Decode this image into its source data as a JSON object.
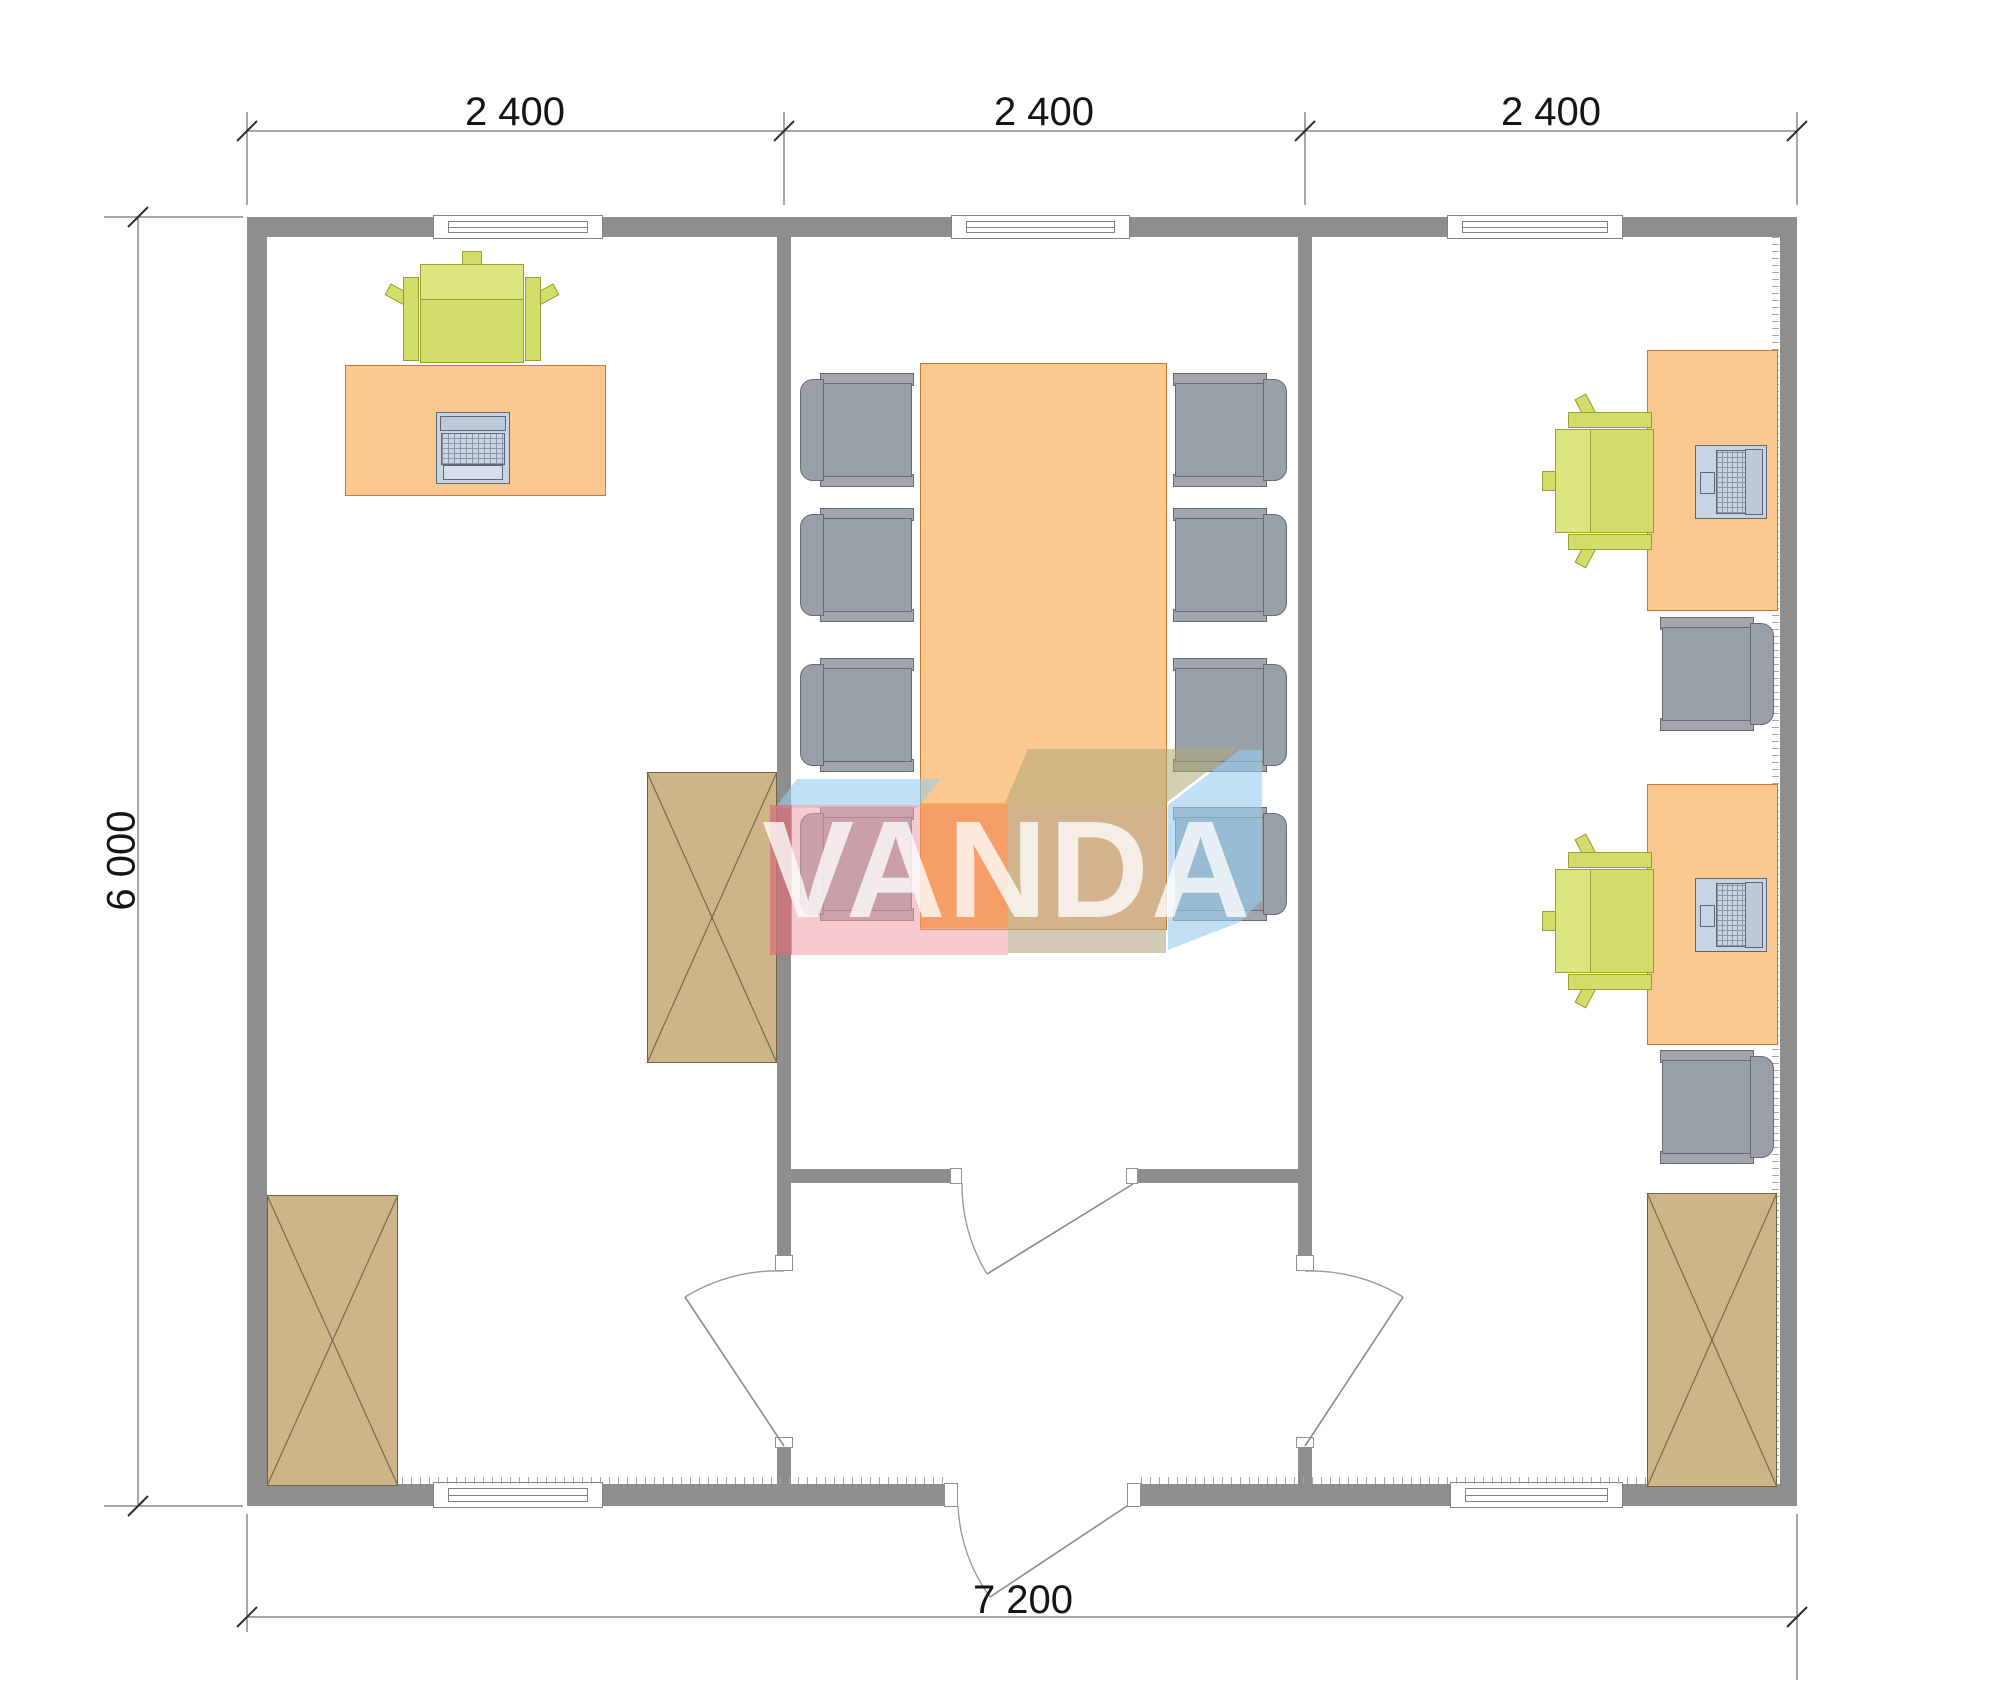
{
  "watermark": {
    "text": "VANDA"
  },
  "dimensions": {
    "top": [
      {
        "label": "2 400"
      },
      {
        "label": "2 400"
      },
      {
        "label": "2 400"
      }
    ],
    "left": {
      "label": "6 000"
    },
    "bottom": {
      "label": "7 200"
    }
  },
  "colors": {
    "background": "#ffffff",
    "wall_gray": "#8e8e8e",
    "desk_orange": "#fbc88f",
    "desk_border": "#c07c34",
    "cabinet_tan": "#cdb588",
    "chair_green": "#d3dd6a",
    "chair_gray": "#9aa0a8",
    "computer_gray_blue": "#c9d4e2",
    "dimension_text": "#141414",
    "logo_pink": "#f09ea8",
    "logo_red": "#c45a5f",
    "logo_orange": "#f48e3c",
    "logo_khaki": "#afaa73",
    "logo_tan": "#baa78a",
    "logo_blue": "#96cdee",
    "logo_text_white": "#ffffff"
  }
}
